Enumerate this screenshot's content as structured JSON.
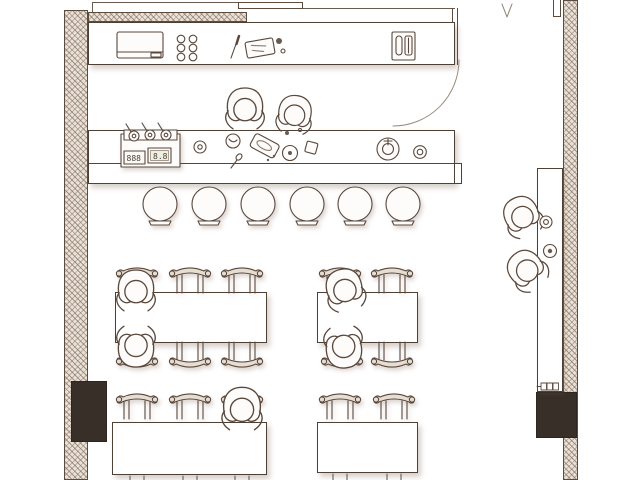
{
  "scene": {
    "type": "floor-plan",
    "view": "top-down architectural drawing",
    "description": "Restaurant floor plan: open kitchen with back counter and cooking bar, six bar stools, four dining tables with chairs, two chefs, five seated guests and two standing guests in the right corridor"
  },
  "palette": {
    "ink": "#5a483c",
    "wall_hatch_line": "#9b8877",
    "wall_hatch_bg": "#eae2d8",
    "column_fill": "#372f28",
    "paper": "#ffffff",
    "furniture_fill": "#ffffff",
    "chair_back_fill": "#e6ddd3",
    "shadow": "rgba(115,88,70,0.28)"
  },
  "kitchen": {
    "cooktop": {
      "left_display": "888",
      "right_display": "8.8",
      "pots": 3
    },
    "hob_rings": 6,
    "equipment": [
      "coffee-machine",
      "knife",
      "cutting-board",
      "condiment-jars",
      "toaster",
      "serving-plate",
      "sink",
      "drain"
    ]
  },
  "seating": {
    "bar_stools": 6,
    "tables": 4,
    "visible_chairs": 15
  },
  "people": {
    "chefs": 2,
    "seated_guests": 5,
    "standing_guests": 2
  }
}
